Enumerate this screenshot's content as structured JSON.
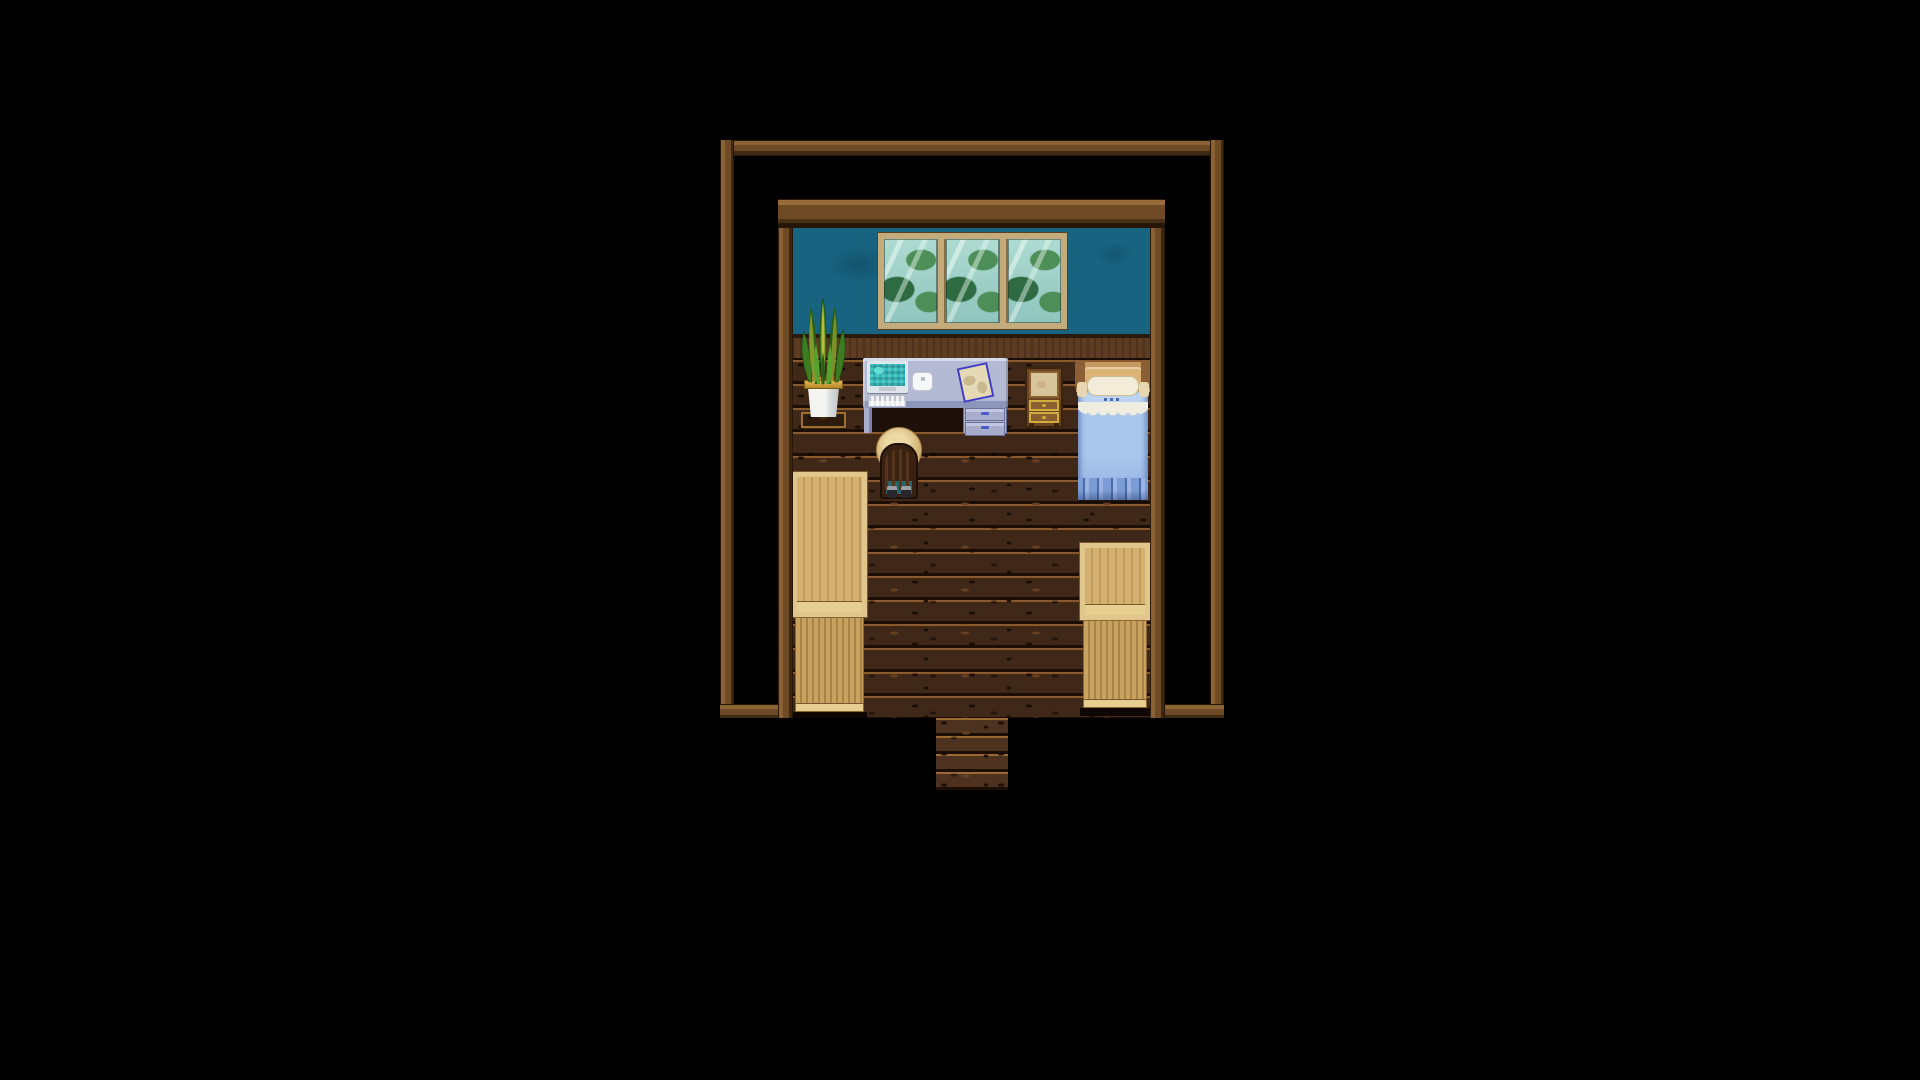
{
  "scene": {
    "description": "Top-down pixel-art RPG interior: a small wooden bedroom surrounded by black void, with an entry walkway at the bottom",
    "style": "rpg-maker-like-tile-map",
    "background": "#000000"
  },
  "room": {
    "label": "bedroom",
    "objects": [
      {
        "id": "house-outline-frame",
        "label": "Thin wooden outline of the house footprint"
      },
      {
        "id": "room-wall-frame",
        "label": "Wooden wall frame around the bedroom"
      },
      {
        "id": "bedroom-wall",
        "label": "Teal wallpaper upper wall"
      },
      {
        "id": "window",
        "label": "Three-pane window with foliage reflections"
      },
      {
        "id": "wall-rail",
        "label": "Brown wainscot rail"
      },
      {
        "id": "wood-floor",
        "label": "Dark wooden plank floor"
      },
      {
        "id": "potted-plant",
        "label": "Snake plant in white planter on tray"
      },
      {
        "id": "computer-desk",
        "label": "Desk with monitor, keyboard, white device and pinned note"
      },
      {
        "id": "desk-chair",
        "label": "Wooden slat chair with straw hat resting on it"
      },
      {
        "id": "wooden-bureau",
        "label": "Small bureau with cream panel and two gold drawers"
      },
      {
        "id": "bed",
        "label": "Single bed with pillow, blue blanket, lace band and fringe"
      },
      {
        "id": "left-cabinet",
        "label": "Tall light-wood cabinet, bottom-left"
      },
      {
        "id": "right-cabinet",
        "label": "Light-wood cabinet, bottom-right"
      },
      {
        "id": "entry-walkway",
        "label": "Plank walkway through the bottom doorway"
      }
    ]
  },
  "palette": {
    "bg": "#000000",
    "wood-hi": "#8a6334",
    "wood-mid": "#6e4b26",
    "wood-lo": "#3f2a13",
    "wood-edge": "#241607",
    "wall-teal": "#176380",
    "wall-teal-dark": "#0f4c63",
    "rail-top": "#2a1a0c",
    "rail-body": "#5d3c22",
    "rail-line": "#1c0f06",
    "floor-base": "#3f2817",
    "floor-line-dark": "#1d0e05",
    "floor-line-light": "#8a5a2c",
    "floor-speck-dark": "#170b03",
    "floor-speck-light": "#6b4424",
    "walk-base": "#4e3220",
    "win-frame": "#c4ab7c",
    "win-frame-dark": "#584022",
    "glass-a": "#aedbd2",
    "glass-b": "#8fc4bc",
    "glass-green": "#4e8e58",
    "glass-green-dark": "#2f6b42",
    "desk-top": "#b4bad4",
    "desk-top-light": "#d7dbe9",
    "desk-front": "#8e95bb",
    "desk-body": "#a7adca",
    "desk-outline": "#6a7098",
    "desk-handle": "#4c5ac8",
    "desk-shadow": "#1c1008",
    "monitor-bezel": "#dee5eb",
    "screen-teal": "#2fbdbd",
    "screen-teal-light": "#63dcd4",
    "keyboard": "#eef0f3",
    "key-grey": "#bfc4cd",
    "mouse": "#f5f7f9",
    "paper": "#e6dab6",
    "paper-mottle": "#c9b98e",
    "paper-pin": "#4040c4",
    "bureau-outline": "#3a2410",
    "bureau-body": "#6b4521",
    "bureau-panel": "#d9c59c",
    "bureau-panel-frame": "#8a6030",
    "bureau-gold": "#d2ae3e",
    "bed-post": "#8a5f33",
    "bed-headboard": "#c59a62",
    "bed-headboard-light": "#dab476",
    "pillow": "#f2ecd8",
    "pillow-edge": "#cdbd96",
    "blanket": "#a9c6ec",
    "blanket-light": "#bdd3f2",
    "blanket-dark": "#8fafe0",
    "lace": "#efece0",
    "fringe": "#7b9cd4",
    "fringe-mid": "#9ab4e4",
    "fringe-dark": "#4a6aa8",
    "leaf-green": "#3c7d22",
    "leaf-dark": "#2a5d16",
    "leaf-light": "#57a32e",
    "leaf-yellow": "#d8cc46",
    "pot-rim-a": "#e0b44c",
    "pot-rim-b": "#b8882e",
    "pot-white-a": "#f4f4f2",
    "pot-white-b": "#b9bec2",
    "soil": "#6b3f18",
    "soil-dot": "#d88a2c",
    "tray": "#9c6f2e",
    "cab-frame": "#e0c68a",
    "cab-face": "#d2b172",
    "cab-grain": "#c19a58",
    "cab-lower": "#c8a360",
    "cab-stripe": "#a8834a",
    "cab-rail": "#e6cd90",
    "cab-edge": "#7a5a2c",
    "hat-a": "#ecd9a6",
    "hat-b": "#d9bc80",
    "hat-c": "#b99458",
    "hat-edge": "#a8854a",
    "chair-dark": "#1c0f07",
    "chair-wood": "#3a2212",
    "chair-post": "#54341d",
    "chair-gap": "#2a6668",
    "shoe-dark": "#26262c",
    "shoe-light": "#9aa0a8"
  }
}
